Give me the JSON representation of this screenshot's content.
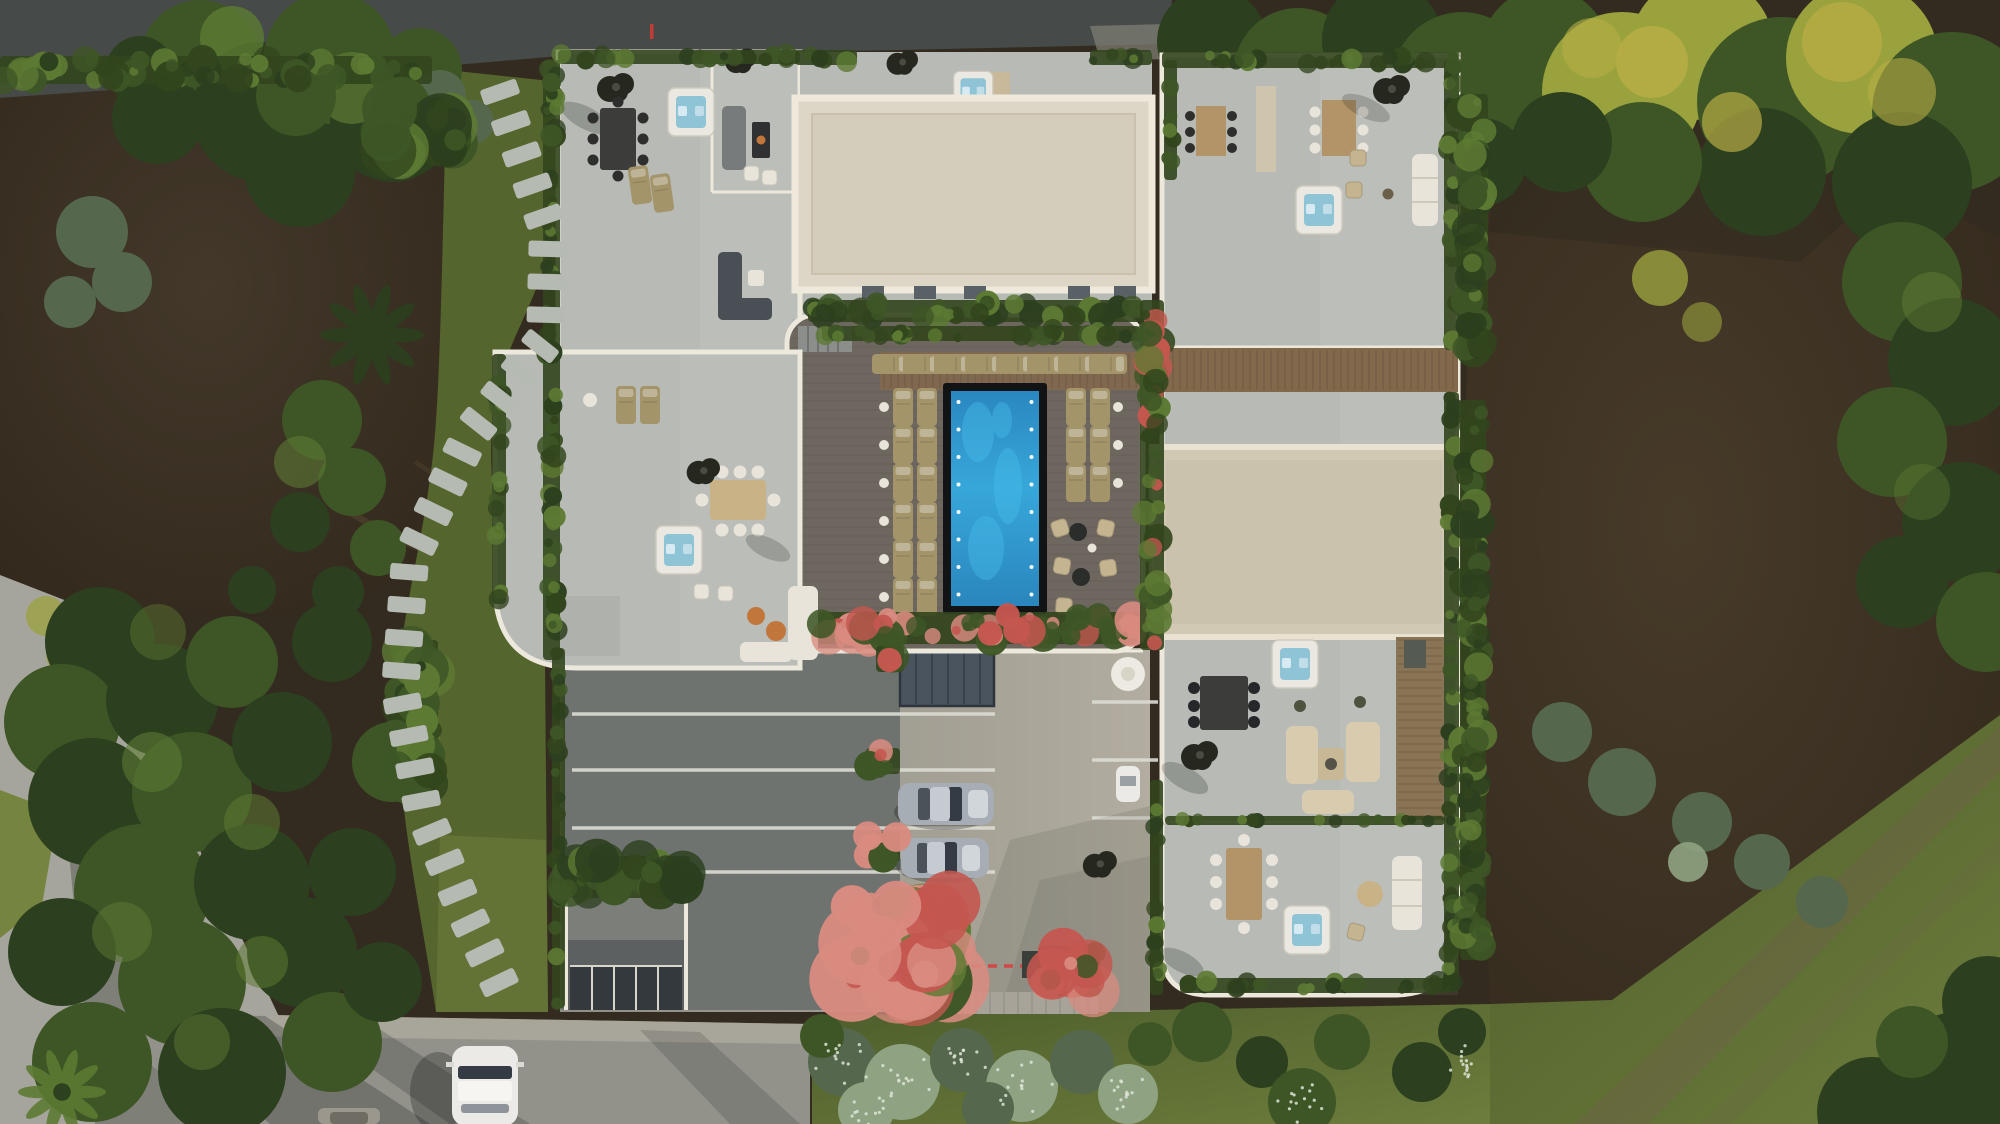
{
  "meta": {
    "title": "Aerial top-down 3D render — modern villa complex with rooftop terraces, central pool courtyard and landscaped garden",
    "type": "architectural-visualization",
    "view": "top-down aerial",
    "lighting": "low warm sun from the right, long soft shadows toward the lower-left"
  },
  "palette": {
    "road_dark": "#464a48",
    "road_light": "#92928b",
    "road_left": "#a6a59d",
    "sidewalk": "#a8a59b",
    "dirt": "#382e21",
    "dirt_light": "#463a29",
    "dirt_right": "#3a2f22",
    "grass_strip": "#55652e",
    "lawn": "#5b6b33",
    "lawn_light": "#75853f",
    "tree_dark": "#2c3f1e",
    "tree_mid": "#3e5626",
    "tree_light": "#5d7a33",
    "tree_yellow": "#9aa23e",
    "tree_yellow_bright": "#b7ad45",
    "tree_bluegreen": "#55684d",
    "sage": "#8fa383",
    "planter_green": "#32451d",
    "flower_red": "#c4574f",
    "flower_pink": "#d98b80",
    "flower_white": "#dde4d6",
    "terrace": "#b7bab5",
    "terrace_light": "#cbcbc4",
    "parapet": "#ece8dc",
    "roof_cream": "#ddd6c6",
    "roof_cream_edge": "#efe9dc",
    "roof_beige": "#d2c9b5",
    "deck": "#6e6760",
    "pergola": "#82694c",
    "wood_strip": "#8a7456",
    "pool_deep": "#1e7cb6",
    "pool_mid": "#2f9ed2",
    "pool_light": "#49c0ec",
    "coping": "#111315",
    "lounger": "#a3946a",
    "concrete": "#8f9089",
    "concrete_light": "#b2ada0",
    "asphalt": "#6e7370",
    "line_white": "#dcdcd4",
    "skylight": "#4a545f",
    "car_silver": "#a7adb4",
    "car_glass": "#343b44",
    "car_white": "#eceae6",
    "hottub_shell": "#eae8e0",
    "hottub_water": "#8fc3d6",
    "furn_white": "#e8e4da",
    "furn_tan": "#c4b490",
    "furn_dark": "#3c3d3a",
    "furn_gray": "#787b7c",
    "sofa_beige": "#d9cbae",
    "wood_table": "#b39468",
    "parasol": "#26271f",
    "fire_orange": "#c1763c",
    "shadow": "#181b16",
    "stone": "#b5bab3"
  },
  "scene": {
    "description": "Modern white multi-unit villa seen from directly above: two large cream roof slabs, grey rooftop terraces edged with green planters, six hot tubs, outdoor dining sets and black parasols; a central courtyard with dark wood deck, tan sun loungers and a rectangular turquoise pool with underwater lights; concrete driveway with parking bays, two parked silver cars, a skylight and a garage ramp; stepping-stone path through grass on the left; roads on the top, left and bottom edges with a white car driving; bare-soil beds and mature trees around the plot and a lawn with a worn path at the lower right.",
    "objects": {
      "pool": {
        "shape": "rectangular",
        "underwater_lights_per_side": 8,
        "lounger_rows_left": 6,
        "lounger_rows_right": 4
      },
      "hot_tubs": 6,
      "dining_sets": 6,
      "parasols": 6,
      "roof_slabs": 2,
      "cars": {
        "parked_silver": 2,
        "driving_white": 1,
        "partial_dark": 1,
        "small_white_cart": 1
      },
      "skylights": 1,
      "garage_ramp": 1,
      "stepping_stones": 30,
      "red_dashed_line": true,
      "flower_colors": [
        "red",
        "pink",
        "white"
      ]
    }
  }
}
